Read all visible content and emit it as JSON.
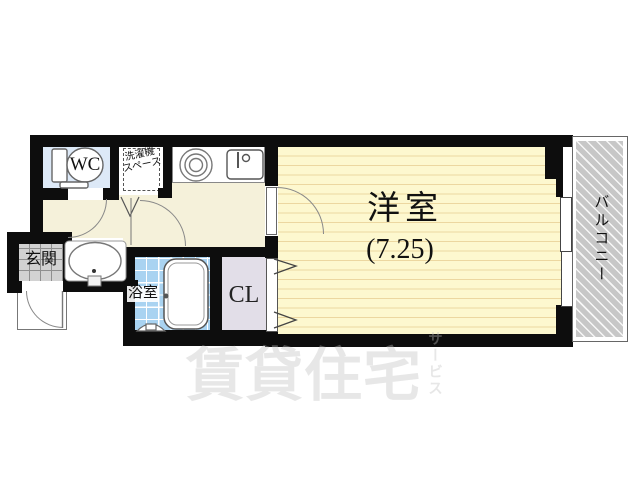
{
  "floorplan": {
    "type": "japanese-apartment-floor-plan-1K",
    "rooms": {
      "wc": {
        "label": "WC"
      },
      "laundry": {
        "line1": "洗濯機",
        "line2": "スペース"
      },
      "main": {
        "label": "洋室",
        "size": "(7.25)"
      },
      "balcony": {
        "label": "バルコニー"
      },
      "entrance": {
        "label": "玄関"
      },
      "bathroom": {
        "label": "浴室"
      },
      "closet": {
        "label": "CL"
      }
    },
    "watermark": {
      "main": "賃貸住宅",
      "sub": "サービス"
    },
    "fixtures": [
      "toilet-icon",
      "washbasin-icon",
      "kitchen-burner-icon",
      "kitchen-sink-icon",
      "bathtub-icon",
      "shower-step-icon",
      "door-swing-arc",
      "folding-door-chevrons",
      "sliding-window"
    ],
    "colors": {
      "wall": "#0d0d0d",
      "hall": "#f5f1da",
      "main_room": "#fdf8cf",
      "main_room_lines": "#ecd7a0",
      "wc_room": "#dde9f7",
      "bath_tiles": "#a9d3f1",
      "entrance_tiles": "#d2d2d2",
      "closet": "#e2dee8",
      "balcony_hatch": "#c7c7c7",
      "watermark": "rgba(192,192,192,0.38)"
    }
  }
}
